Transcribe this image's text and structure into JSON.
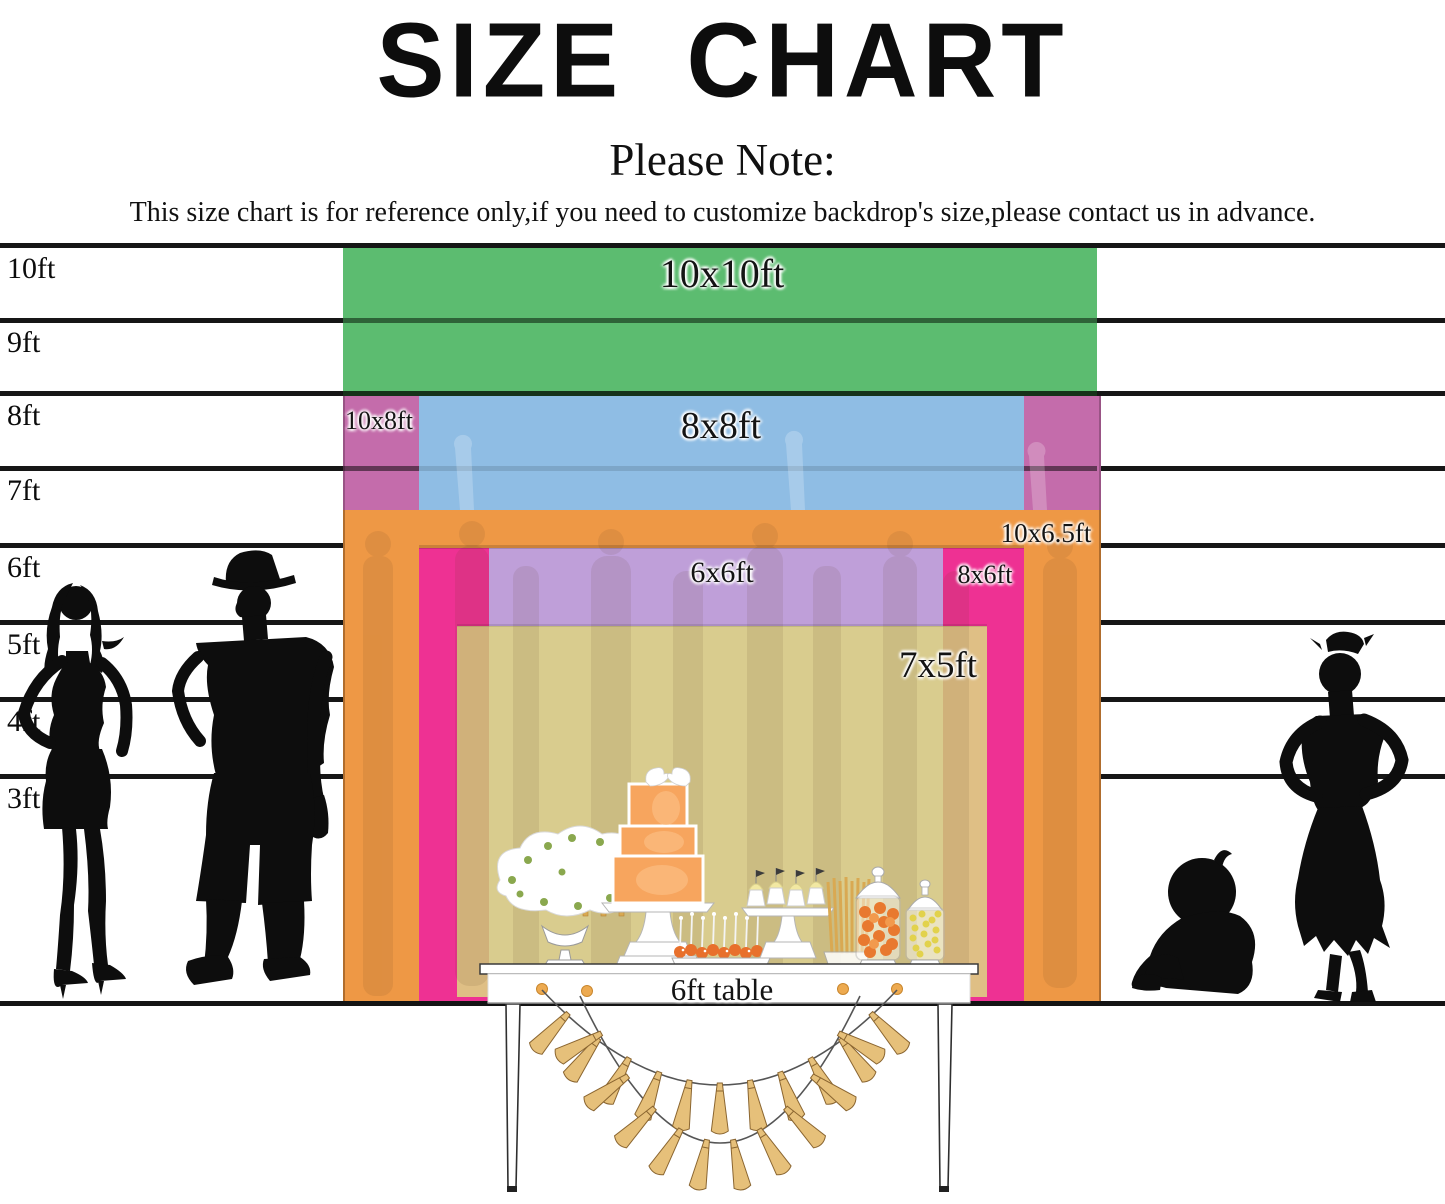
{
  "title": "SIZE CHART",
  "note": {
    "heading": "Please Note:",
    "body": "This size chart is for reference only,if you need to customize backdrop's size,please contact us in advance."
  },
  "ruler": {
    "labels": [
      "10ft",
      "9ft",
      "8ft",
      "7ft",
      "6ft",
      "5ft",
      "4ft",
      "3ft"
    ]
  },
  "sizes": [
    {
      "label": "10x10ft",
      "width_ft": 10,
      "height_ft": 10,
      "color": "#5CBC70"
    },
    {
      "label": "10x8ft",
      "width_ft": 10,
      "height_ft": 8,
      "color": "#C46CAB"
    },
    {
      "label": "8x8ft",
      "width_ft": 8,
      "height_ft": 8,
      "color": "#8FBDE4"
    },
    {
      "label": "10x6.5ft",
      "width_ft": 10,
      "height_ft": 6.5,
      "color": "#EE9845"
    },
    {
      "label": "8x6ft",
      "width_ft": 8,
      "height_ft": 6,
      "color": "#EE3193"
    },
    {
      "label": "6x6ft",
      "width_ft": 6,
      "height_ft": 6,
      "color": "#BF9FD9"
    },
    {
      "label": "7x5ft",
      "width_ft": 7,
      "height_ft": 5,
      "color": "rgba(221,211,131,0.88)"
    }
  ],
  "table": {
    "label": "6ft table"
  }
}
